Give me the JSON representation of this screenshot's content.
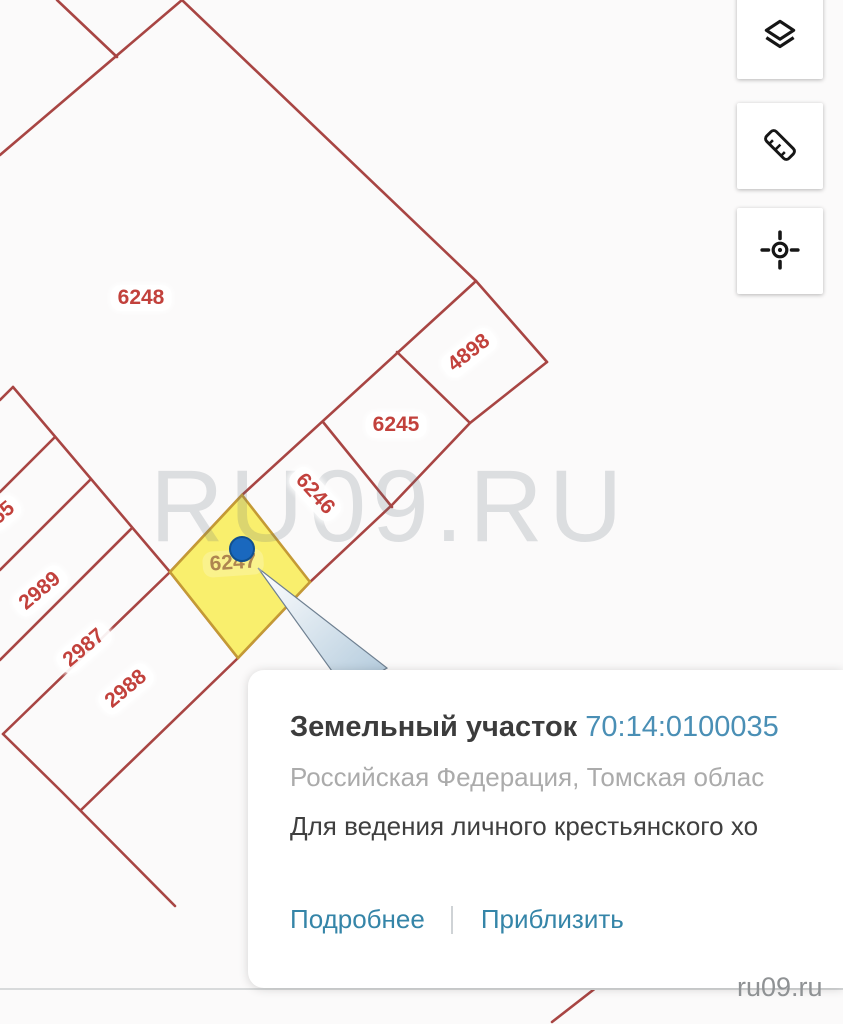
{
  "map": {
    "watermark": "RU09.RU",
    "site_label": "ru09.ru",
    "selected_parcel": {
      "label": "6247",
      "marker_color": "#1a68be",
      "fill": "#f9ef6d",
      "stroke": "#c49a35"
    },
    "parcel_labels": [
      {
        "text": "6248",
        "x": 141,
        "y": 298,
        "rot": 0
      },
      {
        "text": "4898",
        "x": 469,
        "y": 353,
        "rot": -38
      },
      {
        "text": "6245",
        "x": 396,
        "y": 425,
        "rot": 0
      },
      {
        "text": "6246",
        "x": 315,
        "y": 494,
        "rot": 48
      },
      {
        "text": "6247",
        "x": 233,
        "y": 563,
        "rot": -4,
        "muted": true
      },
      {
        "text": "2989",
        "x": 40,
        "y": 591,
        "rot": -40
      },
      {
        "text": "2987",
        "x": 84,
        "y": 648,
        "rot": -40
      },
      {
        "text": "2988",
        "x": 126,
        "y": 689,
        "rot": -40
      },
      {
        "text": "55",
        "x": 3,
        "y": 513,
        "rot": -40
      }
    ],
    "colors": {
      "boundary": "#a84543",
      "label_text": "#c2413c",
      "highlight_fill": "#f9ef6d",
      "highlight_stroke": "#c49a35",
      "marker": "#1a68be",
      "watermark_gray": "#9aa2ac"
    }
  },
  "toolbar": {
    "buttons": [
      {
        "icon": "layers-icon"
      },
      {
        "icon": "ruler-icon"
      },
      {
        "icon": "my-location-icon"
      }
    ]
  },
  "popup": {
    "title": "Земельный участок",
    "cadastral_number": "70:14:0100035",
    "address": "Российская Федерация, Томская облас",
    "usage": "Для ведения личного крестьянского хо",
    "actions": [
      {
        "label": "Подробнее"
      },
      {
        "label": "Приблизить"
      }
    ]
  }
}
